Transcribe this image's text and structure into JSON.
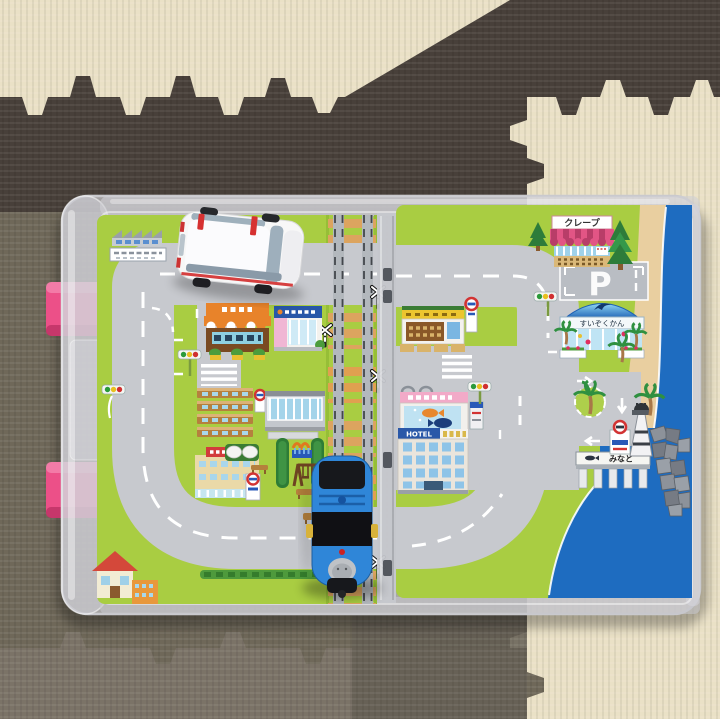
{
  "objects": {
    "train_toy": "thomas-blue-tank-engine-toy",
    "vehicle_toy": "white-ambulance-toy",
    "container": "clear-plastic-carry-case",
    "background": "interlocking-foam-puzzle-mats"
  },
  "labels": {
    "crepe_shop": "クレープ",
    "aquarium": "すいぞくかん",
    "harbor": "みなと",
    "hotel": "HOTEL",
    "parking": "P"
  },
  "colors": {
    "mat_cream": "#eae1c6",
    "mat_dark_brown": "#48403a",
    "mat_gray": "#6f6859",
    "mat_gray_light": "#7b7367",
    "latch_pink": "#ec5088",
    "map_green": "#a9cd42",
    "road_gray": "#c7c9ce",
    "ocean_blue": "#1e6cc0",
    "beach_sand": "#e9cfa0",
    "train_blue": "#2f86d8",
    "ambulance_white": "#f7f7f7",
    "tie_tan": "#dca45f"
  }
}
